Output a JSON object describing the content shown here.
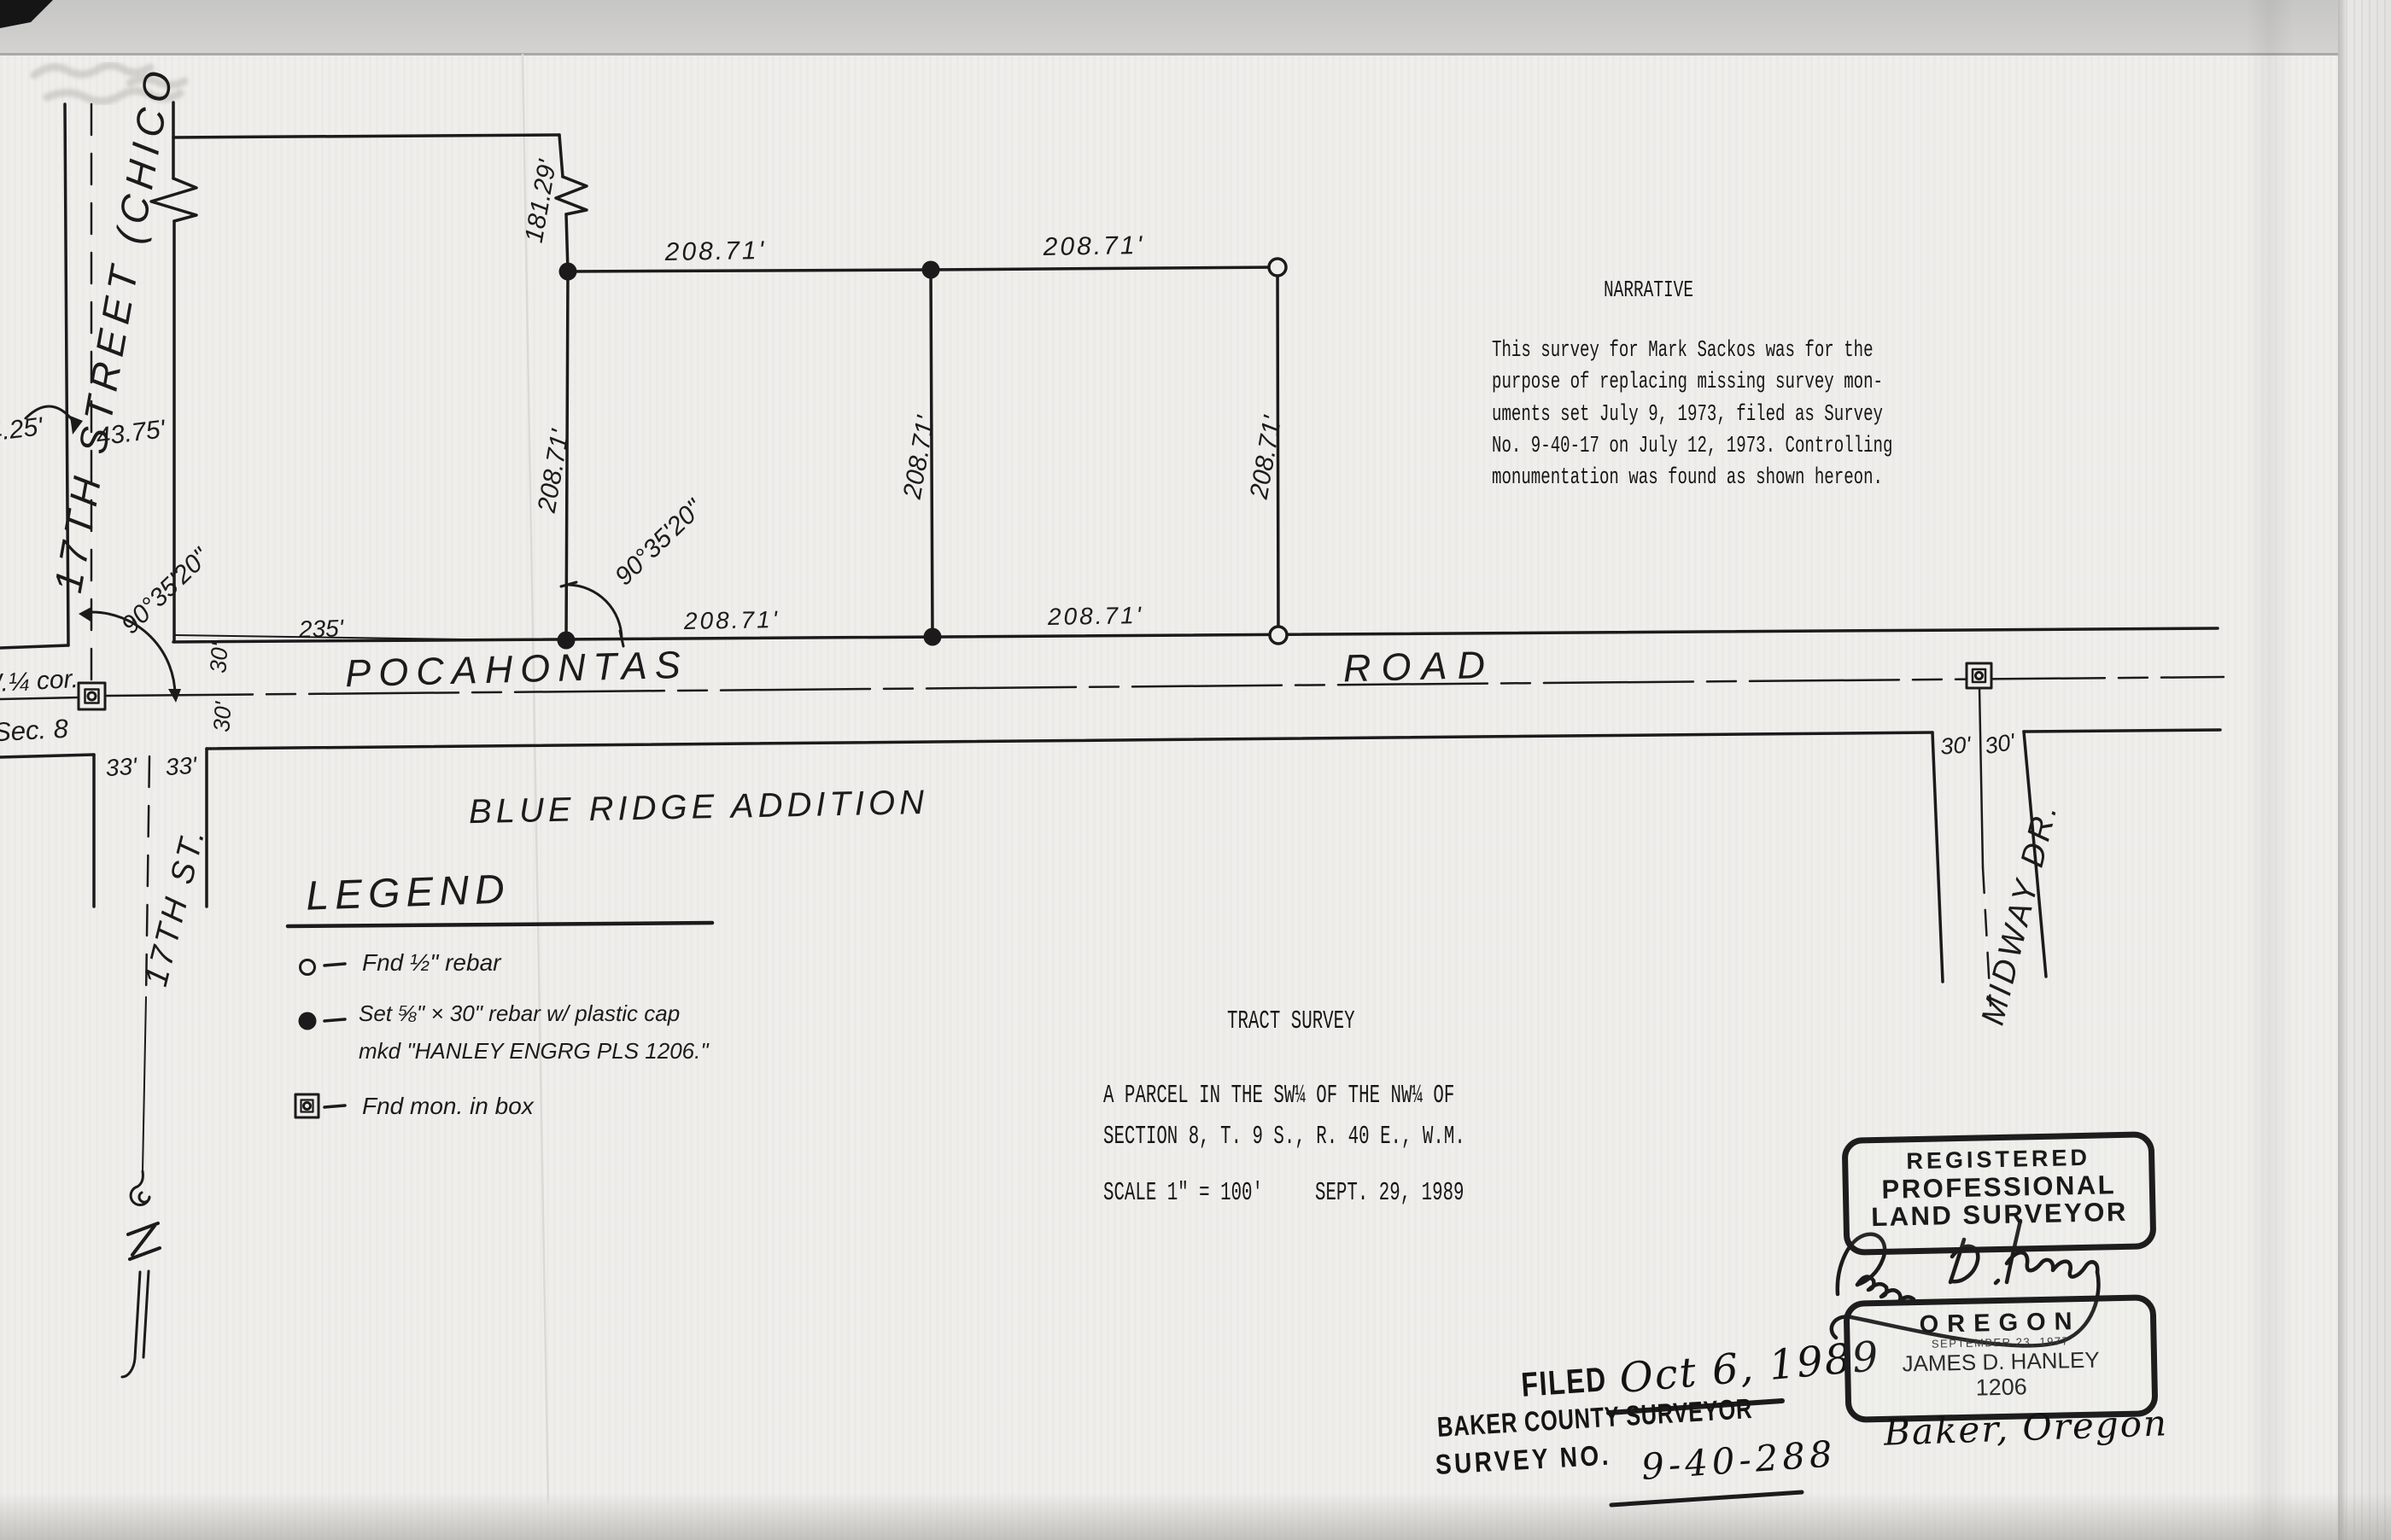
{
  "colors": {
    "ink": "#1b1b1b",
    "paper": "#efeeeb"
  },
  "narrative": {
    "title": "NARRATIVE",
    "lines": [
      "This survey for Mark Sackos was for the",
      "purpose of replacing missing survey mon-",
      "uments set July 9, 1973, filed as Survey",
      "No. 9-40-17 on July 12, 1973. Controlling",
      "monumentation was found as shown hereon."
    ]
  },
  "tract": {
    "title": "TRACT SURVEY",
    "description_line1": "A PARCEL IN THE SW¼ OF THE NW¼ OF",
    "description_line2": "SECTION 8, T. 9 S., R. 40 E., W.M.",
    "scale": "SCALE 1\" = 100'",
    "date": "SEPT. 29, 1989"
  },
  "legend": {
    "title": "LEGEND",
    "items": [
      {
        "symbol": "open-circle",
        "text": "Fnd ½\" rebar"
      },
      {
        "symbol": "filled-circle",
        "text": "Set ⅝\" × 30\" rebar w/ plastic cap",
        "text2": "mkd \"HANLEY ENGRG PLS 1206.\""
      },
      {
        "symbol": "monument-box",
        "text": "Fnd mon. in box"
      }
    ]
  },
  "labels": {
    "subdivision": "BLUE RIDGE ADDITION",
    "street_17_north": "17TH STREET (CHICO",
    "street_17_south": "17TH ST.",
    "pocahontas": "POCAHONTAS",
    "road": "ROAD",
    "midway": "MIDWAY DR.",
    "quarter_corner": "W.¼ cor.",
    "section": "Sec. 8"
  },
  "dimensions": {
    "lot_width": "208.71'",
    "remainder_north": "181.29'",
    "road_west": "235'",
    "angle": "90°35'20\"",
    "half_33": "33'",
    "half_30": "30'",
    "cl_east": "43.75'",
    "cl_west": "4.25'"
  },
  "filed_stamp": {
    "filed_label": "FILED",
    "date": "Oct 6, 1989",
    "office": "BAKER COUNTY SURVEYOR",
    "survey_no_label": "SURVEY NO.",
    "survey_no": "9-40-288"
  },
  "surveyor_stamp": {
    "registered": "REGISTERED",
    "professional": "PROFESSIONAL",
    "land_surveyor": "LAND SURVEYOR",
    "state": "OREGON",
    "registration_date": "SEPTEMBER 23, 1977",
    "name": "JAMES D. HANLEY",
    "number": "1206",
    "signature": "James D. Hanley",
    "city": "Baker, Oregon"
  }
}
